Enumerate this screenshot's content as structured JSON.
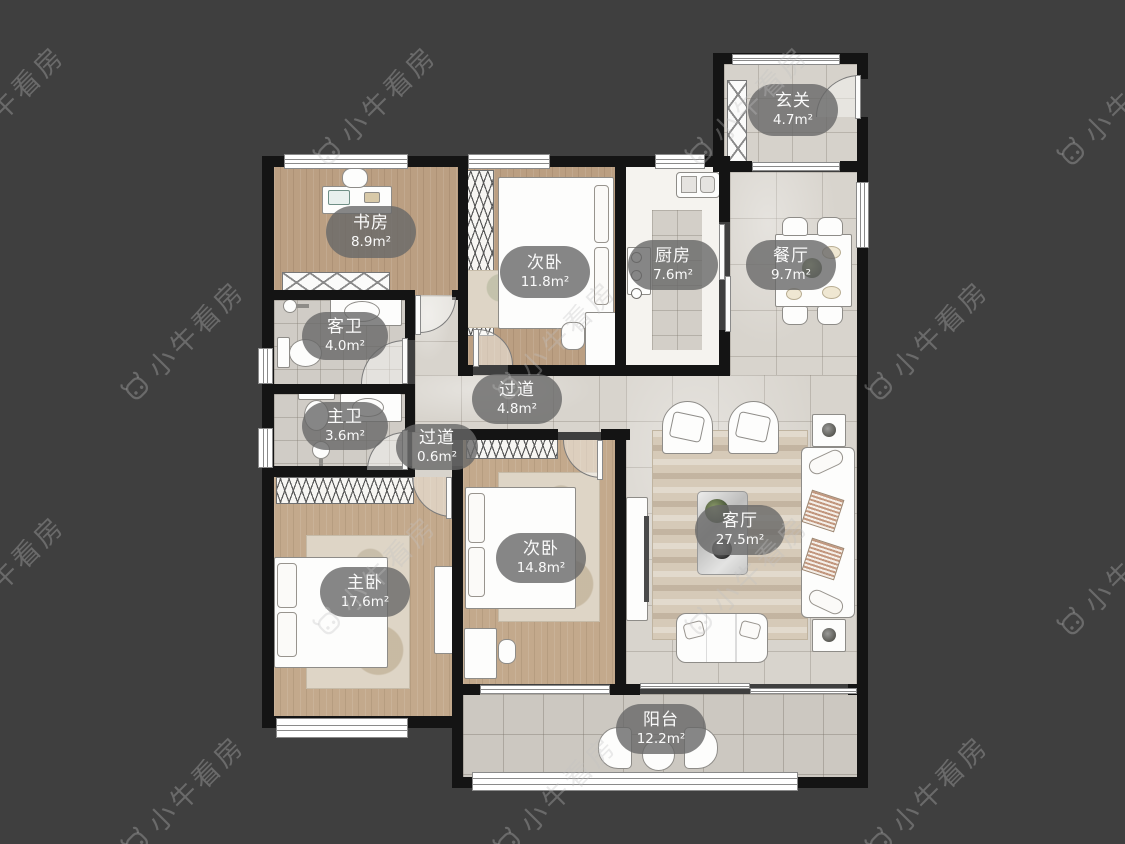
{
  "watermark": {
    "text": "小牛看房"
  },
  "rooms": [
    {
      "key": "entry",
      "name": "玄关",
      "area": "4.7m²"
    },
    {
      "key": "study",
      "name": "书房",
      "area": "8.9m²"
    },
    {
      "key": "bedroom-top",
      "name": "次卧",
      "area": "11.8m²"
    },
    {
      "key": "kitchen",
      "name": "厨房",
      "area": "7.6m²"
    },
    {
      "key": "dining",
      "name": "餐厅",
      "area": "9.7m²"
    },
    {
      "key": "guest-bath",
      "name": "客卫",
      "area": "4.0m²"
    },
    {
      "key": "hallway",
      "name": "过道",
      "area": "4.8m²"
    },
    {
      "key": "master-bath",
      "name": "主卫",
      "area": "3.6m²"
    },
    {
      "key": "hallway-small",
      "name": "过道",
      "area": "0.6m²"
    },
    {
      "key": "master-bedroom",
      "name": "主卧",
      "area": "17.6m²"
    },
    {
      "key": "bedroom-bottom",
      "name": "次卧",
      "area": "14.8m²"
    },
    {
      "key": "living",
      "name": "客厅",
      "area": "27.5m²"
    },
    {
      "key": "balcony",
      "name": "阳台",
      "area": "12.2m²"
    }
  ],
  "colors": {
    "background": "#3f3f3f",
    "wall": "#141414",
    "wood_floor": "#bb9f82",
    "tile_floor": "#d8d4cd",
    "label_pill": "#686868",
    "furniture": "#fdfdfc"
  }
}
